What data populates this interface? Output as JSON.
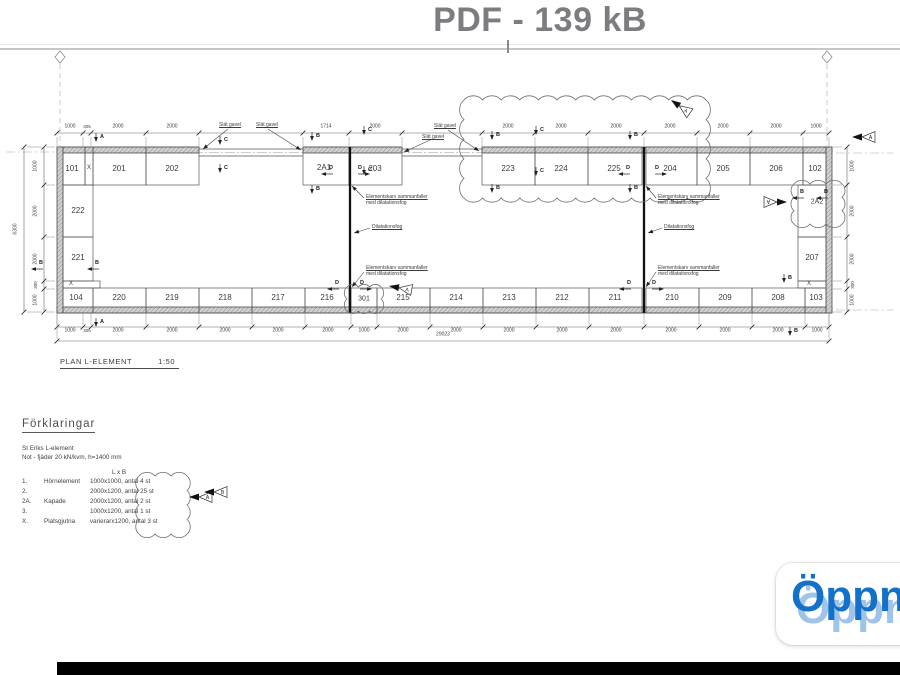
{
  "header": {
    "title": "PDF - 139 kB"
  },
  "plan": {
    "caption": "PLAN L-ELEMENT",
    "scale": "1:50",
    "total_width": "29023",
    "total_height": "6300",
    "cells": [
      {
        "t": "101",
        "x": 72,
        "y": 169
      },
      {
        "t": "X",
        "x": 89,
        "y": 168,
        "c": "sm"
      },
      {
        "t": "201",
        "x": 119,
        "y": 169
      },
      {
        "t": "202",
        "x": 172,
        "y": 169
      },
      {
        "t": "2A1",
        "x": 324,
        "y": 168
      },
      {
        "t": "203",
        "x": 375,
        "y": 169
      },
      {
        "t": "223",
        "x": 508,
        "y": 169
      },
      {
        "t": "224",
        "x": 561,
        "y": 169
      },
      {
        "t": "225",
        "x": 614,
        "y": 169
      },
      {
        "t": "204",
        "x": 670,
        "y": 169
      },
      {
        "t": "205",
        "x": 723,
        "y": 169
      },
      {
        "t": "206",
        "x": 776,
        "y": 169
      },
      {
        "t": "102",
        "x": 815,
        "y": 169
      },
      {
        "t": "222",
        "x": 78,
        "y": 211
      },
      {
        "t": "221",
        "x": 78,
        "y": 258
      },
      {
        "t": "X",
        "x": 71,
        "y": 284,
        "c": "sm"
      },
      {
        "t": "2A2",
        "x": 817,
        "y": 202,
        "c": "md"
      },
      {
        "t": "207",
        "x": 812,
        "y": 258
      },
      {
        "t": "X",
        "x": 809,
        "y": 284,
        "c": "sm"
      },
      {
        "t": "104",
        "x": 76,
        "y": 298
      },
      {
        "t": "220",
        "x": 119,
        "y": 298
      },
      {
        "t": "219",
        "x": 172,
        "y": 298
      },
      {
        "t": "218",
        "x": 225,
        "y": 298
      },
      {
        "t": "217",
        "x": 278,
        "y": 298
      },
      {
        "t": "216",
        "x": 327,
        "y": 298
      },
      {
        "t": "301",
        "x": 364,
        "y": 299,
        "c": "md"
      },
      {
        "t": "215",
        "x": 403,
        "y": 298
      },
      {
        "t": "214",
        "x": 456,
        "y": 298
      },
      {
        "t": "213",
        "x": 509,
        "y": 298
      },
      {
        "t": "212",
        "x": 562,
        "y": 298
      },
      {
        "t": "211",
        "x": 615,
        "y": 298
      },
      {
        "t": "210",
        "x": 672,
        "y": 298
      },
      {
        "t": "209",
        "x": 725,
        "y": 298
      },
      {
        "t": "208",
        "x": 778,
        "y": 298
      },
      {
        "t": "103",
        "x": 816,
        "y": 298
      }
    ],
    "top_dims": [
      {
        "t": "1000",
        "x": 70
      },
      {
        "t": "305",
        "x": 87,
        "c": "tiny"
      },
      {
        "t": "2000",
        "x": 118
      },
      {
        "t": "2000",
        "x": 172
      },
      {
        "t": "1714",
        "x": 326
      },
      {
        "t": "2000",
        "x": 375
      },
      {
        "t": "2000",
        "x": 508
      },
      {
        "t": "2000",
        "x": 561
      },
      {
        "t": "2000",
        "x": 616
      },
      {
        "t": "2000",
        "x": 670
      },
      {
        "t": "2000",
        "x": 723
      },
      {
        "t": "2000",
        "x": 776
      },
      {
        "t": "1000",
        "x": 816
      }
    ],
    "bottom_dims": [
      {
        "t": "1000",
        "x": 70
      },
      {
        "t": "305",
        "x": 87,
        "c": "tiny"
      },
      {
        "t": "2000",
        "x": 118
      },
      {
        "t": "2000",
        "x": 172
      },
      {
        "t": "2000",
        "x": 225
      },
      {
        "t": "2000",
        "x": 278
      },
      {
        "t": "2000",
        "x": 328
      },
      {
        "t": "1000",
        "x": 364
      },
      {
        "t": "2000",
        "x": 403
      },
      {
        "t": "2000",
        "x": 456
      },
      {
        "t": "2000",
        "x": 509
      },
      {
        "t": "2000",
        "x": 562
      },
      {
        "t": "2000",
        "x": 616
      },
      {
        "t": "2000",
        "x": 671
      },
      {
        "t": "2000",
        "x": 725
      },
      {
        "t": "2000",
        "x": 778
      },
      {
        "t": "1000",
        "x": 817
      }
    ],
    "left_dims": [
      {
        "t": "1000",
        "y": 166
      },
      {
        "t": "2000",
        "y": 211
      },
      {
        "t": "2000",
        "y": 259
      },
      {
        "t": "300",
        "y": 285,
        "c": "tiny"
      },
      {
        "t": "1000",
        "y": 300
      }
    ],
    "right_dims": [
      {
        "t": "1000",
        "y": 166
      },
      {
        "t": "2000",
        "y": 211
      },
      {
        "t": "2000",
        "y": 259
      },
      {
        "t": "300",
        "y": 285,
        "c": "tiny"
      },
      {
        "t": "1000",
        "y": 300
      }
    ],
    "markers": [
      {
        "t": "A",
        "x": 102,
        "y": 137,
        "dir": "down"
      },
      {
        "t": "A",
        "x": 102,
        "y": 322,
        "dir": "down"
      },
      {
        "t": "B",
        "x": 318,
        "y": 136,
        "dir": "down"
      },
      {
        "t": "B",
        "x": 318,
        "y": 189,
        "dir": "down"
      },
      {
        "t": "C",
        "x": 226,
        "y": 140,
        "dir": "down"
      },
      {
        "t": "C",
        "x": 226,
        "y": 168,
        "dir": "down"
      },
      {
        "t": "C",
        "x": 370,
        "y": 130,
        "dir": "down"
      },
      {
        "t": "C",
        "x": 370,
        "y": 170,
        "dir": "down"
      },
      {
        "t": "B",
        "x": 498,
        "y": 135,
        "dir": "down"
      },
      {
        "t": "B",
        "x": 498,
        "y": 188,
        "dir": "down"
      },
      {
        "t": "C",
        "x": 542,
        "y": 130,
        "dir": "down"
      },
      {
        "t": "C",
        "x": 542,
        "y": 171,
        "dir": "down"
      },
      {
        "t": "B",
        "x": 636,
        "y": 135,
        "dir": "down"
      },
      {
        "t": "B",
        "x": 636,
        "y": 188,
        "dir": "down"
      },
      {
        "t": "D",
        "x": 331,
        "y": 168,
        "dir": "left"
      },
      {
        "t": "D",
        "x": 360,
        "y": 168,
        "dir": "right"
      },
      {
        "t": "D",
        "x": 628,
        "y": 168,
        "dir": "left"
      },
      {
        "t": "D",
        "x": 657,
        "y": 168,
        "dir": "right"
      },
      {
        "t": "D",
        "x": 337,
        "y": 283,
        "dir": "left"
      },
      {
        "t": "D",
        "x": 362,
        "y": 283,
        "dir": "right"
      },
      {
        "t": "D",
        "x": 629,
        "y": 283,
        "dir": "left"
      },
      {
        "t": "D",
        "x": 654,
        "y": 283,
        "dir": "right"
      },
      {
        "t": "B",
        "x": 41,
        "y": 263,
        "dir": "left"
      },
      {
        "t": "B",
        "x": 97,
        "y": 263,
        "dir": "left"
      },
      {
        "t": "B",
        "x": 802,
        "y": 192,
        "dir": "left"
      },
      {
        "t": "B",
        "x": 826,
        "y": 192,
        "dir": "left"
      },
      {
        "t": "B",
        "x": 790,
        "y": 278,
        "dir": "down"
      },
      {
        "t": "B",
        "x": 796,
        "y": 331,
        "dir": "down"
      }
    ],
    "flags": [
      {
        "t": "A",
        "x": 852,
        "y": 137,
        "rot": 0
      },
      {
        "t": "A",
        "x": 671,
        "y": 100,
        "rot": 35
      },
      {
        "t": "A",
        "x": 787,
        "y": 202,
        "rot": 180
      },
      {
        "t": "A",
        "x": 389,
        "y": 286,
        "rot": 10
      },
      {
        "t": "A",
        "x": 189,
        "y": 497,
        "rot": 0
      },
      {
        "t": "B",
        "x": 204,
        "y": 492,
        "rot": 0
      }
    ],
    "notes": [
      {
        "t": "Slät gavel",
        "x": 219,
        "y": 122,
        "lead": [
          228,
          129,
          203,
          149
        ]
      },
      {
        "t": "Slät gavel",
        "x": 256,
        "y": 122,
        "lead": [
          268,
          129,
          301,
          150
        ]
      },
      {
        "t": "Slät gavel",
        "x": 434,
        "y": 123,
        "lead": [
          448,
          130,
          479,
          151
        ]
      },
      {
        "t": "Slät gavel",
        "x": 422,
        "y": 134,
        "lead": [
          430,
          140,
          404,
          152
        ]
      },
      {
        "l1": "Elementskarv sammanfaller",
        "l2": "med dilatationsfog",
        "x": 366,
        "y": 194,
        "lead": [
          364,
          198,
          352,
          186
        ]
      },
      {
        "l1": "Elementskarv sammanfaller",
        "l2": "med dilatationsfog",
        "x": 366,
        "y": 265,
        "lead": [
          364,
          272,
          352,
          287
        ]
      },
      {
        "l1": "Elementskarv sammanfaller",
        "l2": "med dilatationsfog",
        "x": 658,
        "y": 194,
        "lead": [
          656,
          198,
          646,
          186
        ]
      },
      {
        "l1": "Elementskarv sammanfaller",
        "l2": "med dilatationsfog",
        "x": 658,
        "y": 265,
        "lead": [
          656,
          272,
          646,
          287
        ]
      },
      {
        "t": "Dilatationsfog",
        "x": 372,
        "y": 224,
        "lead": [
          370,
          228,
          354,
          233
        ]
      },
      {
        "t": "Dilatationsfog",
        "x": 664,
        "y": 224,
        "lead": [
          662,
          228,
          648,
          233
        ]
      }
    ]
  },
  "legend": {
    "heading": "Förklaringar",
    "subtitle1": "St Eriks L-element",
    "subtitle2": "Not - fjäder 20 kN/kvm, h=1400 mm",
    "col_header": "L x B",
    "rows": [
      {
        "no": "1.",
        "name": "Hörnelement",
        "spec": "1000x1000, antal 4 st"
      },
      {
        "no": "2.",
        "name": "",
        "spec": "2000x1200, antal 25 st"
      },
      {
        "no": "2A.",
        "name": "Kapade",
        "spec": "2000x1200, antal 2 st"
      },
      {
        "no": "3.",
        "name": "",
        "spec": "1000x1200, antal 1 st"
      },
      {
        "no": "X.",
        "name": "Platsgjutna",
        "spec": "varierarx1200, antal 3 st"
      }
    ]
  },
  "open_button": {
    "label": "Öppn",
    "color": "#1471c9"
  }
}
